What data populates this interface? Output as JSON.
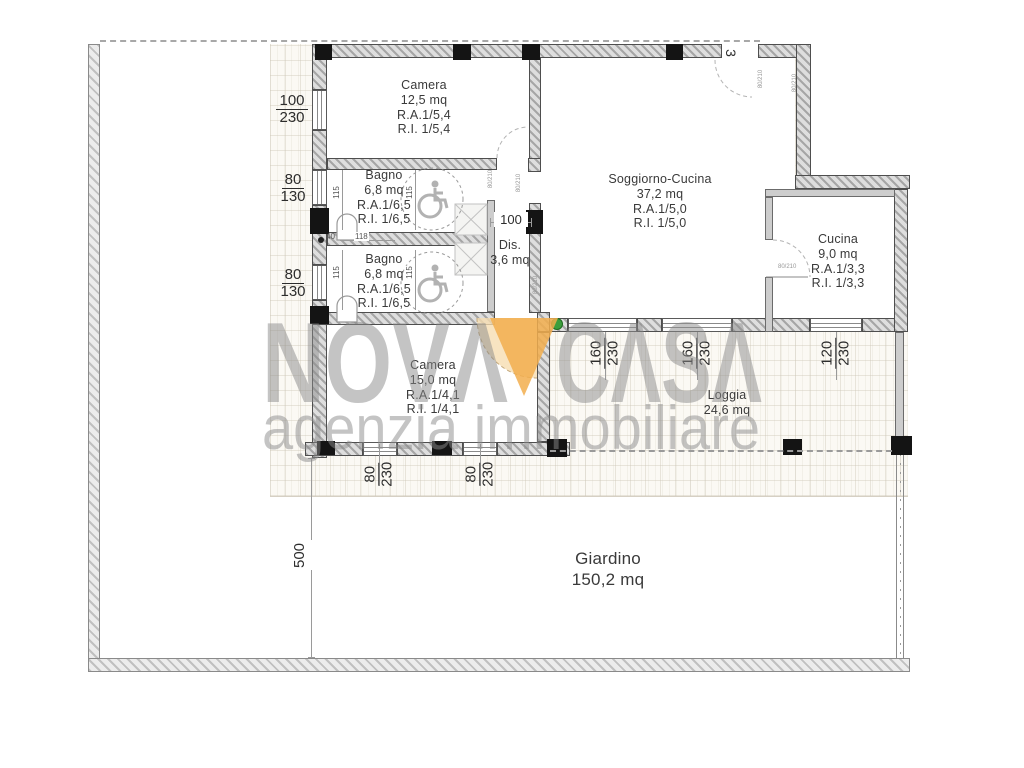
{
  "watermark": {
    "brand_left": "NOVΛ",
    "brand_right": "CΛSΛ",
    "tagline": "agenzia immobiliare"
  },
  "colors": {
    "triangle_orange": "#f2ae4e",
    "door_fan_tan": "#f6ddb0",
    "watermark_gray": "#8e8e8e",
    "marker_green": "#3c9e3c",
    "wall_gray": "#a6a6a6"
  },
  "plan": {
    "entrance_label": "3",
    "rooms": {
      "camera1": {
        "name": "Camera",
        "area": "12,5 mq",
        "ra": "R.A.1/5,4",
        "ri": "R.I. 1/5,4"
      },
      "bagno1": {
        "name": "Bagno",
        "area": "6,8 mq",
        "ra": "R.A.1/6,5",
        "ri": "R.I. 1/6,5"
      },
      "bagno2": {
        "name": "Bagno",
        "area": "6,8 mq",
        "ra": "R.A.1/6,5",
        "ri": "R.I. 1/6,5"
      },
      "dis": {
        "name": "Dis.",
        "area": "3,6 mq"
      },
      "soggiorno": {
        "name": "Soggiorno-Cucina",
        "area": "37,2 mq",
        "ra": "R.A.1/5,0",
        "ri": "R.I. 1/5,0"
      },
      "cucina": {
        "name": "Cucina",
        "area": "9,0 mq",
        "ra": "R.A.1/3,3",
        "ri": "R.I. 1/3,3"
      },
      "camera2": {
        "name": "Camera",
        "area": "15,0 mq",
        "ra": "R.A.1/4,1",
        "ri": "R.I. 1/4,1"
      },
      "loggia": {
        "name": "Loggia",
        "area": "24,6 mq"
      },
      "giardino": {
        "name": "Giardino",
        "area": "150,2 mq"
      }
    },
    "dims": {
      "left": [
        {
          "num": "100",
          "den": "230"
        },
        {
          "num": "80",
          "den": "130"
        },
        {
          "num": "80",
          "den": "130"
        }
      ],
      "bottom": [
        {
          "num": "80",
          "den": "230"
        },
        {
          "num": "80",
          "den": "230"
        }
      ],
      "loggia": [
        {
          "num": "160",
          "den": "230"
        },
        {
          "num": "160",
          "den": "230"
        },
        {
          "num": "120",
          "den": "230"
        }
      ],
      "garden_depth": "500",
      "dis_width": "100",
      "corridor": {
        "a": "40",
        "b": "118"
      },
      "fixture_width": "115",
      "door_size": "80/210"
    }
  }
}
